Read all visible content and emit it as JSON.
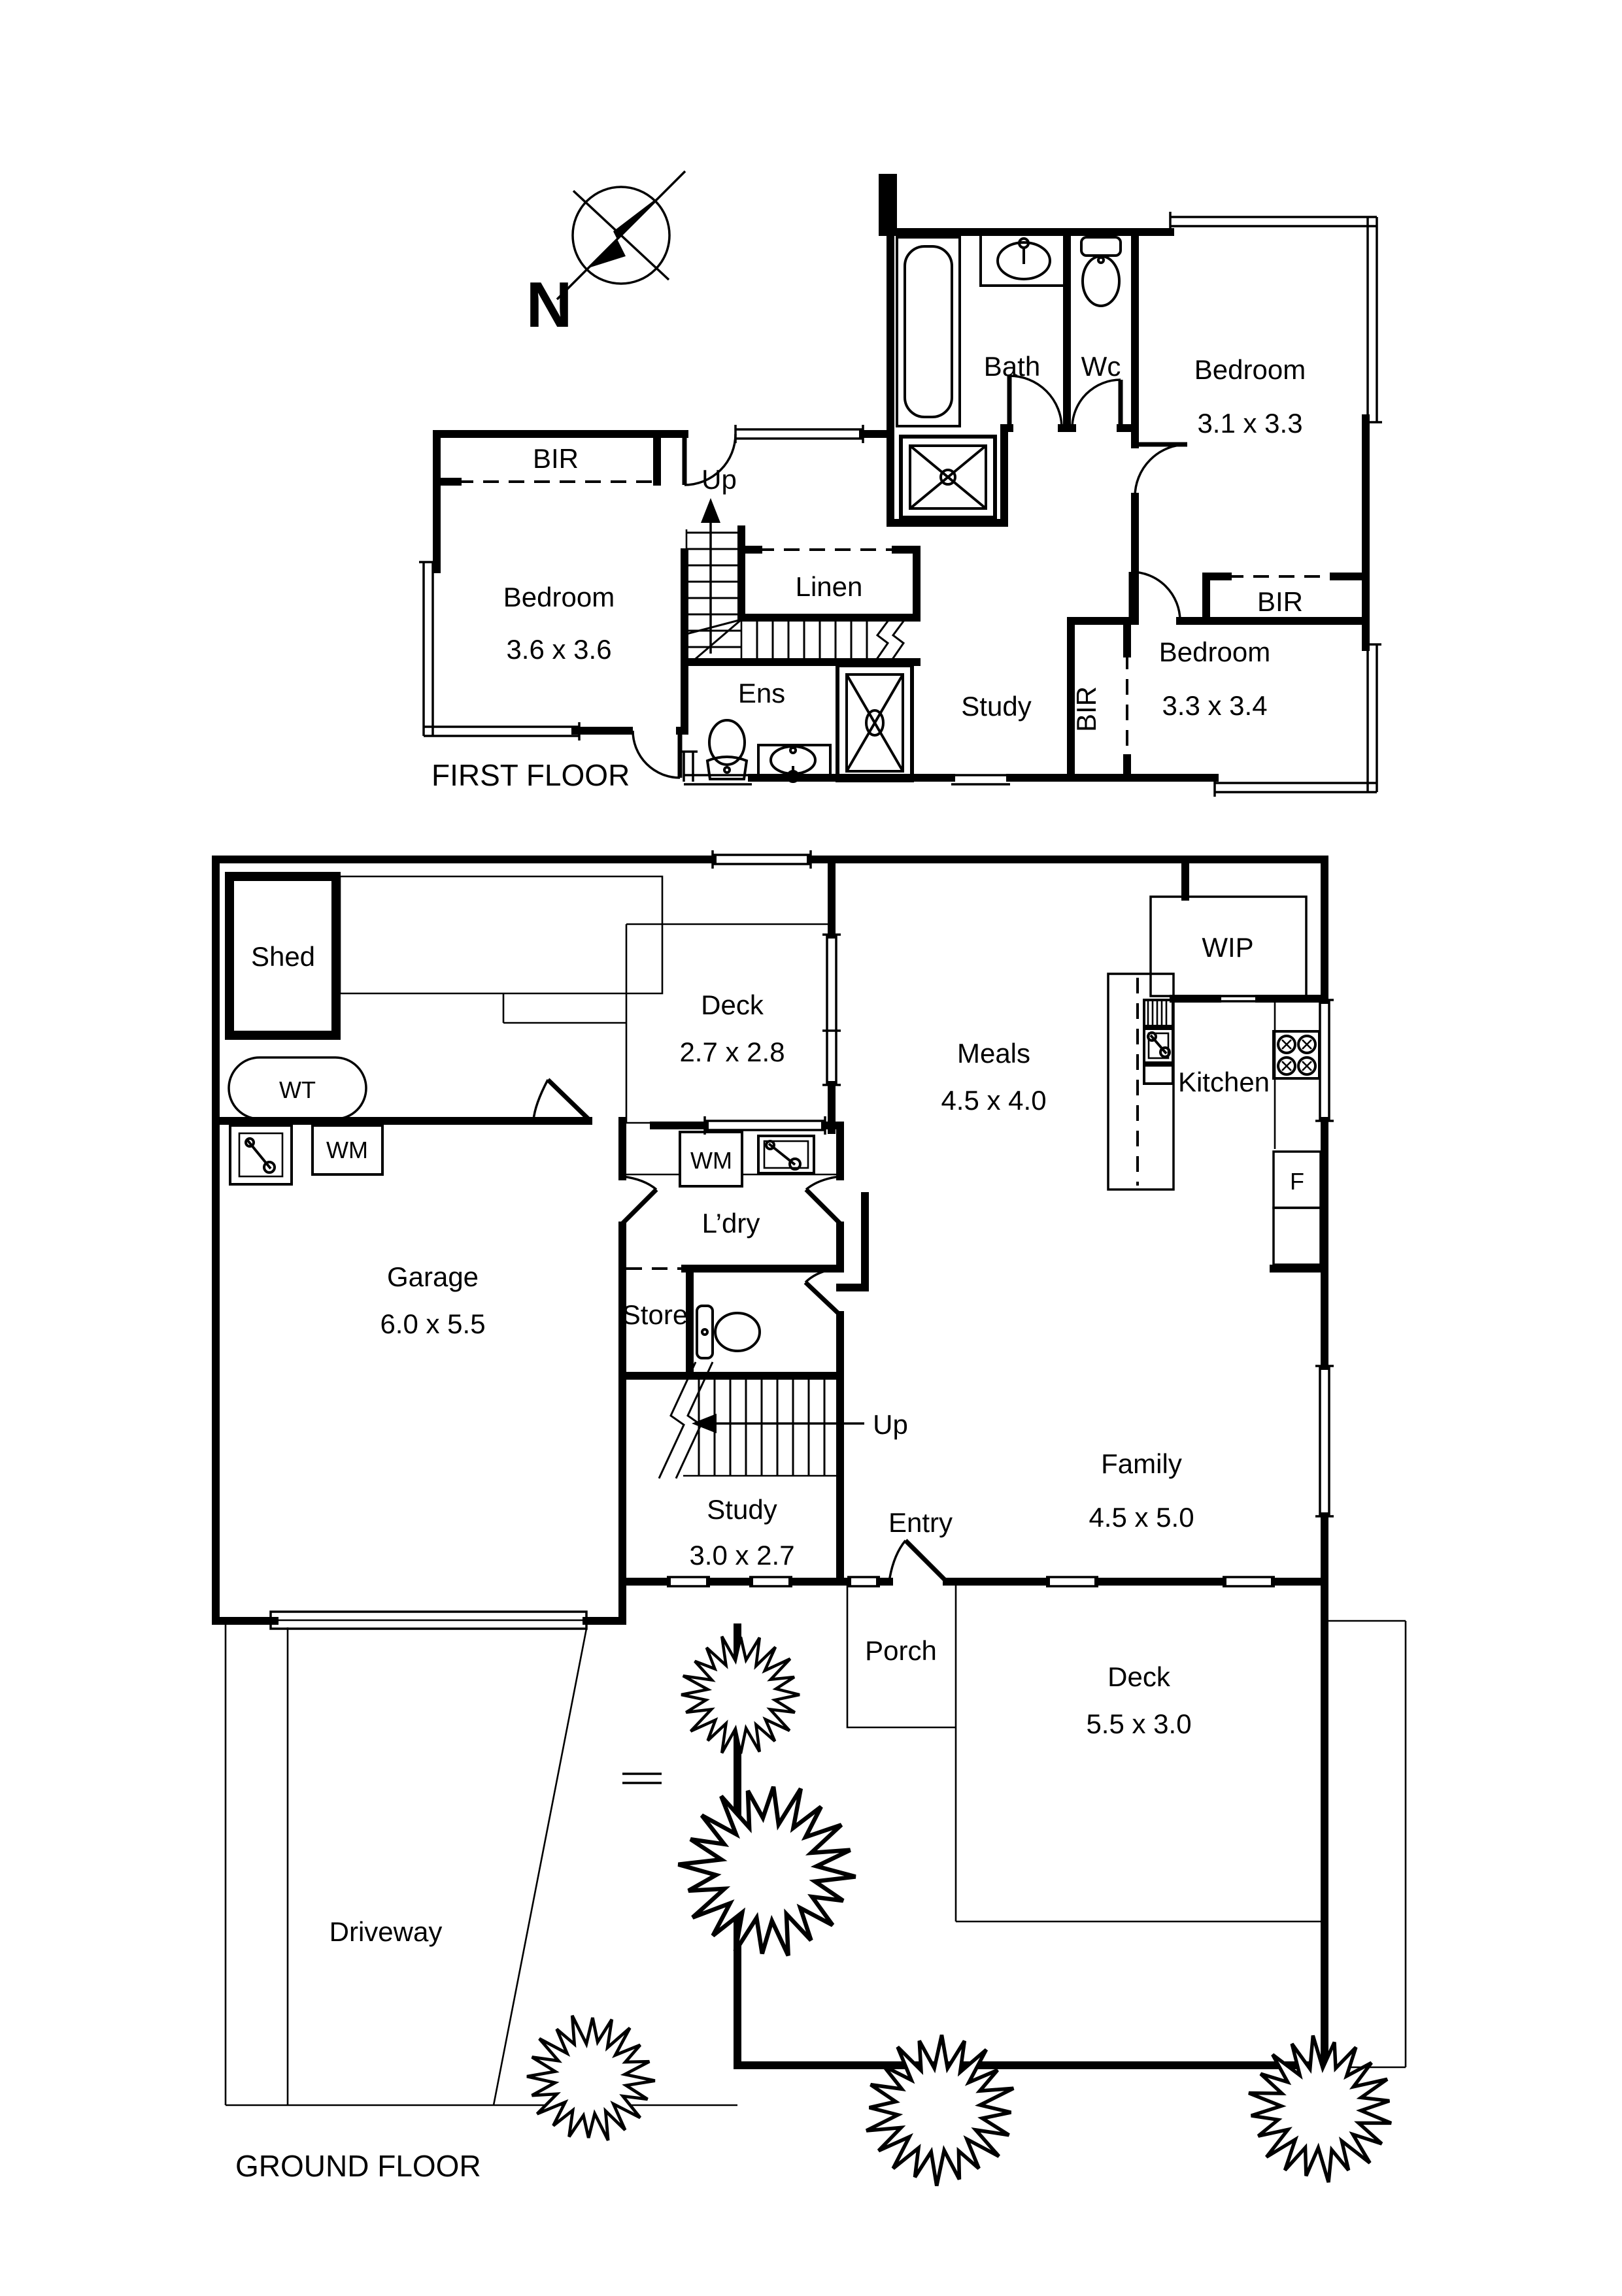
{
  "colors": {
    "ink": "#000000",
    "paper": "#ffffff"
  },
  "compass": {
    "label": "N"
  },
  "first_floor": {
    "title": "FIRST FLOOR",
    "bath": "Bath",
    "wc": "Wc",
    "bed1_name": "Bedroom",
    "bed1_dims": "3.1 x 3.3",
    "bed2_name": "Bedroom",
    "bed2_dims": "3.6 x 3.6",
    "bed3_name": "Bedroom",
    "bed3_dims": "3.3 x 3.4",
    "bir_left": "BIR",
    "bir_right": "BIR",
    "bir_side": "BIR",
    "linen": "Linen",
    "study": "Study",
    "ens": "Ens",
    "up": "Up"
  },
  "ground_floor": {
    "title": "GROUND FLOOR",
    "shed": "Shed",
    "water_tank": "WT",
    "wm_garage": "WM",
    "wm_laundry": "WM",
    "deck_top_name": "Deck",
    "deck_top_dims": "2.7 x 2.8",
    "meals_name": "Meals",
    "meals_dims": "4.5 x 4.0",
    "wip": "WIP",
    "kitchen": "Kitchen",
    "fridge": "F",
    "laundry": "L’dry",
    "store": "Store",
    "up": "Up",
    "garage_name": "Garage",
    "garage_dims": "6.0 x 5.5",
    "study_name": "Study",
    "study_dims": "3.0 x 2.7",
    "entry": "Entry",
    "family_name": "Family",
    "family_dims": "4.5 x 5.0",
    "porch": "Porch",
    "deck_rear_name": "Deck",
    "deck_rear_dims": "5.5 x 3.0",
    "driveway": "Driveway"
  }
}
